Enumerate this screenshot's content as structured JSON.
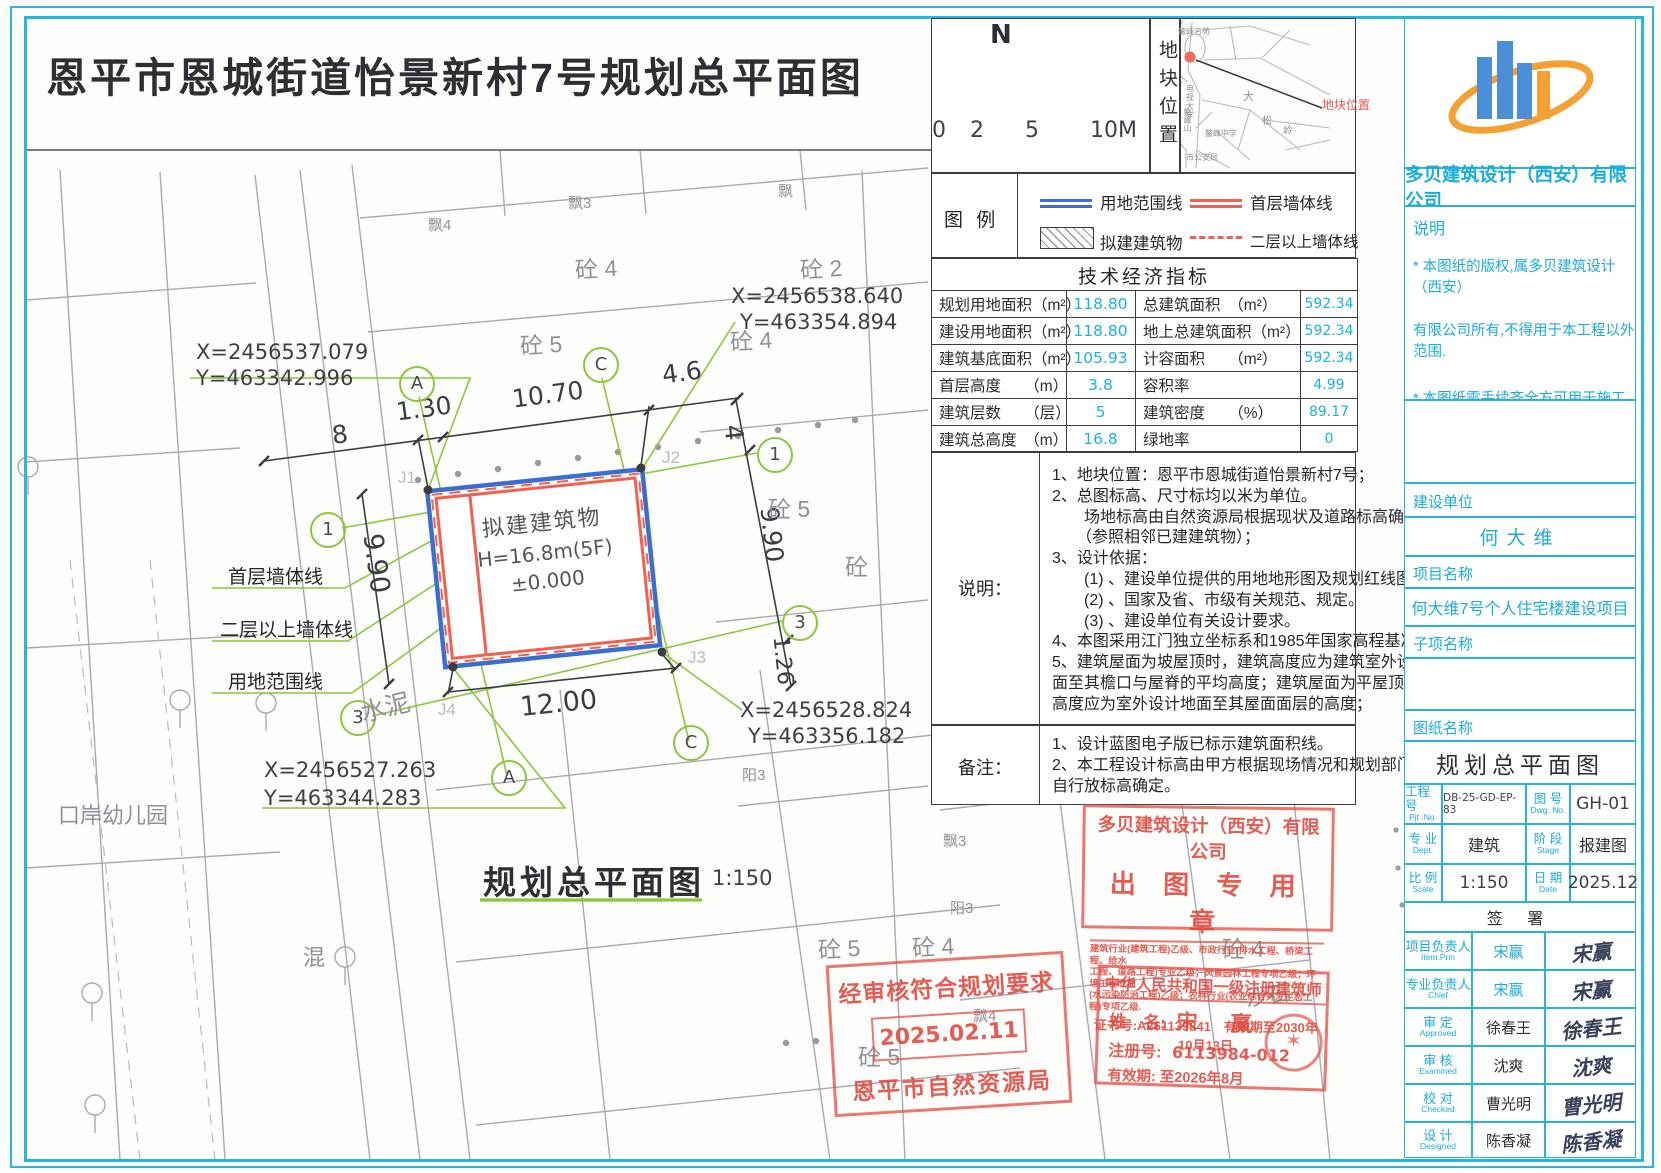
{
  "page_title": "恩平市恩城街道怡景新村7号规划总平面图",
  "plan": {
    "subtitle": "规划总平面图",
    "scale": "1:150",
    "building": {
      "name": "拟建建筑物",
      "height": "H=16.8m(5F)",
      "level": "±0.000"
    },
    "corner_points": [
      "J1",
      "J2",
      "J3",
      "J4"
    ],
    "coords": [
      {
        "x": "X=2456537.079",
        "y": "Y=463342.996"
      },
      {
        "x": "X=2456538.640",
        "y": "Y=463354.894"
      },
      {
        "x": "X=2456528.824",
        "y": "Y=463356.182"
      },
      {
        "x": "X=2456527.263",
        "y": "Y=463344.283"
      }
    ],
    "dims": {
      "top": [
        "8",
        "1.30",
        "10.70",
        "4.6"
      ],
      "right": [
        "4",
        "9.90",
        "1.26"
      ],
      "left": [
        "9.90"
      ],
      "bottom": [
        "12.00"
      ]
    },
    "line_labels": [
      "首层墙体线",
      "二层以上墙体线",
      "用地范围线"
    ],
    "axis_bubbles": {
      "top": [
        "A",
        "C"
      ],
      "bottom": [
        "A",
        "C"
      ],
      "left": [
        "1",
        "3"
      ],
      "right": [
        "1",
        "3"
      ]
    },
    "site_labels": [
      "砼 4",
      "砼 2",
      "砼 5",
      "砼 4",
      "飘4",
      "飘3",
      "飘",
      "砼 5",
      "砼",
      "水泥",
      "口岸幼儿园",
      "混",
      "阳3",
      "砼 5",
      "砼 4",
      "飘3",
      "阳3",
      "飘4",
      "砼 5",
      "砼 4",
      "沙石"
    ]
  },
  "north": {
    "label": "N",
    "scale_ticks": [
      "0",
      "2",
      "5",
      "10M"
    ]
  },
  "location_map": {
    "side_label": "地块位置",
    "marker_label": "地块位置",
    "labels": [
      "鳌峰名苑",
      "电视大学",
      "鳌峰中学",
      "鳌峰山",
      "大",
      "松",
      "岭",
      "市公安局"
    ]
  },
  "legend": {
    "title": "图 例",
    "items": [
      "用地范围线",
      "首层墙体线",
      "拟建建筑物",
      "二层以上墙体线"
    ]
  },
  "indicators": {
    "title": "技术经济指标",
    "rows": [
      [
        "规划用地面积（m²）",
        "118.80",
        "总建筑面积　（m²）",
        "592.34"
      ],
      [
        "建设用地面积（m²）",
        "118.80",
        "地上总建筑面积（m²）",
        "592.34"
      ],
      [
        "建筑基底面积（m²）",
        "105.93",
        "计容面积　　（m²）",
        "592.34"
      ],
      [
        "首层高度　　（m）",
        "3.8",
        "容积率",
        "4.99"
      ],
      [
        "建筑层数　　（层）",
        "5",
        "建筑密度　　（%）",
        "89.17"
      ],
      [
        "建筑总高度　（m）",
        "16.8",
        "绿地率",
        "0"
      ]
    ]
  },
  "notes": {
    "label": "说明：",
    "lines": [
      "1、地块位置：恩平市恩城街道怡景新村7号；",
      "2、总图标高、尺寸标均以米为单位。",
      "　　场地标高由自然资源局根据现状及道路标高确定",
      "　　（参照相邻已建建筑物）；",
      "3、设计依据：",
      "　　(1) 、建设单位提供的用地地形图及规划红线图。",
      "　　(2) 、国家及省、市级有关规范、规定。",
      "　　(3) 、建设单位有关设计要求。",
      "4、本图采用江门独立坐标系和1985年国家高程基准；",
      "5、建筑屋面为坡屋顶时，建筑高度应为建筑室外设计地",
      "面至其檐口与屋脊的平均高度；建筑屋面为平屋顶时，建筑",
      "高度应为室外设计地面至其屋面面层的高度；"
    ]
  },
  "remarks": {
    "label": "备注：",
    "lines": [
      "1、设计蓝图电子版已标示建筑面积线。",
      "2、本工程设计标高由甲方根据现场情况和规划部门要求",
      "自行放标高确定。"
    ]
  },
  "titleblock": {
    "company": "多贝建筑设计（西安）有限公司",
    "notice_title": "说明",
    "notice_lines": [
      "* 本图纸的版权,属多贝建筑设计（西安）",
      "有限公司所有,不得用于本工程以外范围.",
      "* 本图纸需手续齐全方可用于施工."
    ],
    "owner_label": "建设单位",
    "owner": "何大维",
    "project_label": "项目名称",
    "project": "何大维7号个人住宅楼建设项目",
    "subproject_label": "子项名称",
    "subproject": "",
    "sheet_label": "图纸名称",
    "sheet": "规划总平面图",
    "meta": [
      {
        "l1": "工程号",
        "s1": "Pjt .No.",
        "v1": "DB-25-GD-EP-83",
        "l2": "图 号",
        "s2": "Dwg. No.",
        "v2": "GH-01"
      },
      {
        "l1": "专 业",
        "s1": "Dept.",
        "v1": "建筑",
        "l2": "阶 段",
        "s2": "Stage",
        "v2": "报建图"
      },
      {
        "l1": "比 例",
        "s1": "Scale",
        "v1": "1:150",
        "l2": "日 期",
        "s2": "Date",
        "v2": "2025.12"
      }
    ],
    "sign_header": "签 署",
    "signers": [
      {
        "role": "项目负责人",
        "en": "Item.Prin",
        "name": "宋赢",
        "sig": "宋赢"
      },
      {
        "role": "专业负责人",
        "en": "Chief",
        "name": "宋赢",
        "sig": "宋赢"
      },
      {
        "role": "审 定",
        "en": "Approved",
        "name": "徐春王",
        "sig": "徐春王"
      },
      {
        "role": "审 核",
        "en": "Examined",
        "name": "沈爽",
        "sig": "沈爽"
      },
      {
        "role": "校 对",
        "en": "Checked",
        "name": "曹光明",
        "sig": "曹光明"
      },
      {
        "role": "设 计",
        "en": "Designed",
        "name": "陈香凝",
        "sig": "陈香凝"
      }
    ]
  },
  "stamps": {
    "company": {
      "line1": "多贝建筑设计（西安）有限公司",
      "line2": "出 图 专 用 章",
      "small1": "建筑行业(建筑工程)乙级、市政行业(排水工程、桥梁工程、给水",
      "small2": "工程、道路工程)专业乙级；风景园林工程专项乙级；环境工程专项",
      "small3": "(水污染防治工程)乙级；农林行业(农业综合开发生态工程)专项乙级.",
      "cert": "证书号:A261139841　有效期至2030年10月13日"
    },
    "approval": {
      "line1": "经审核符合规划要求",
      "date": "2025.02.11",
      "line2": "恩平市自然资源局"
    },
    "architect": {
      "title": "中华人民共和国一级注册建筑师",
      "name_label": "姓　名:",
      "name": "宋　赢",
      "reg_label": "注册号:",
      "reg": "6113984-012",
      "valid": "有效期: 至2026年8月"
    }
  }
}
